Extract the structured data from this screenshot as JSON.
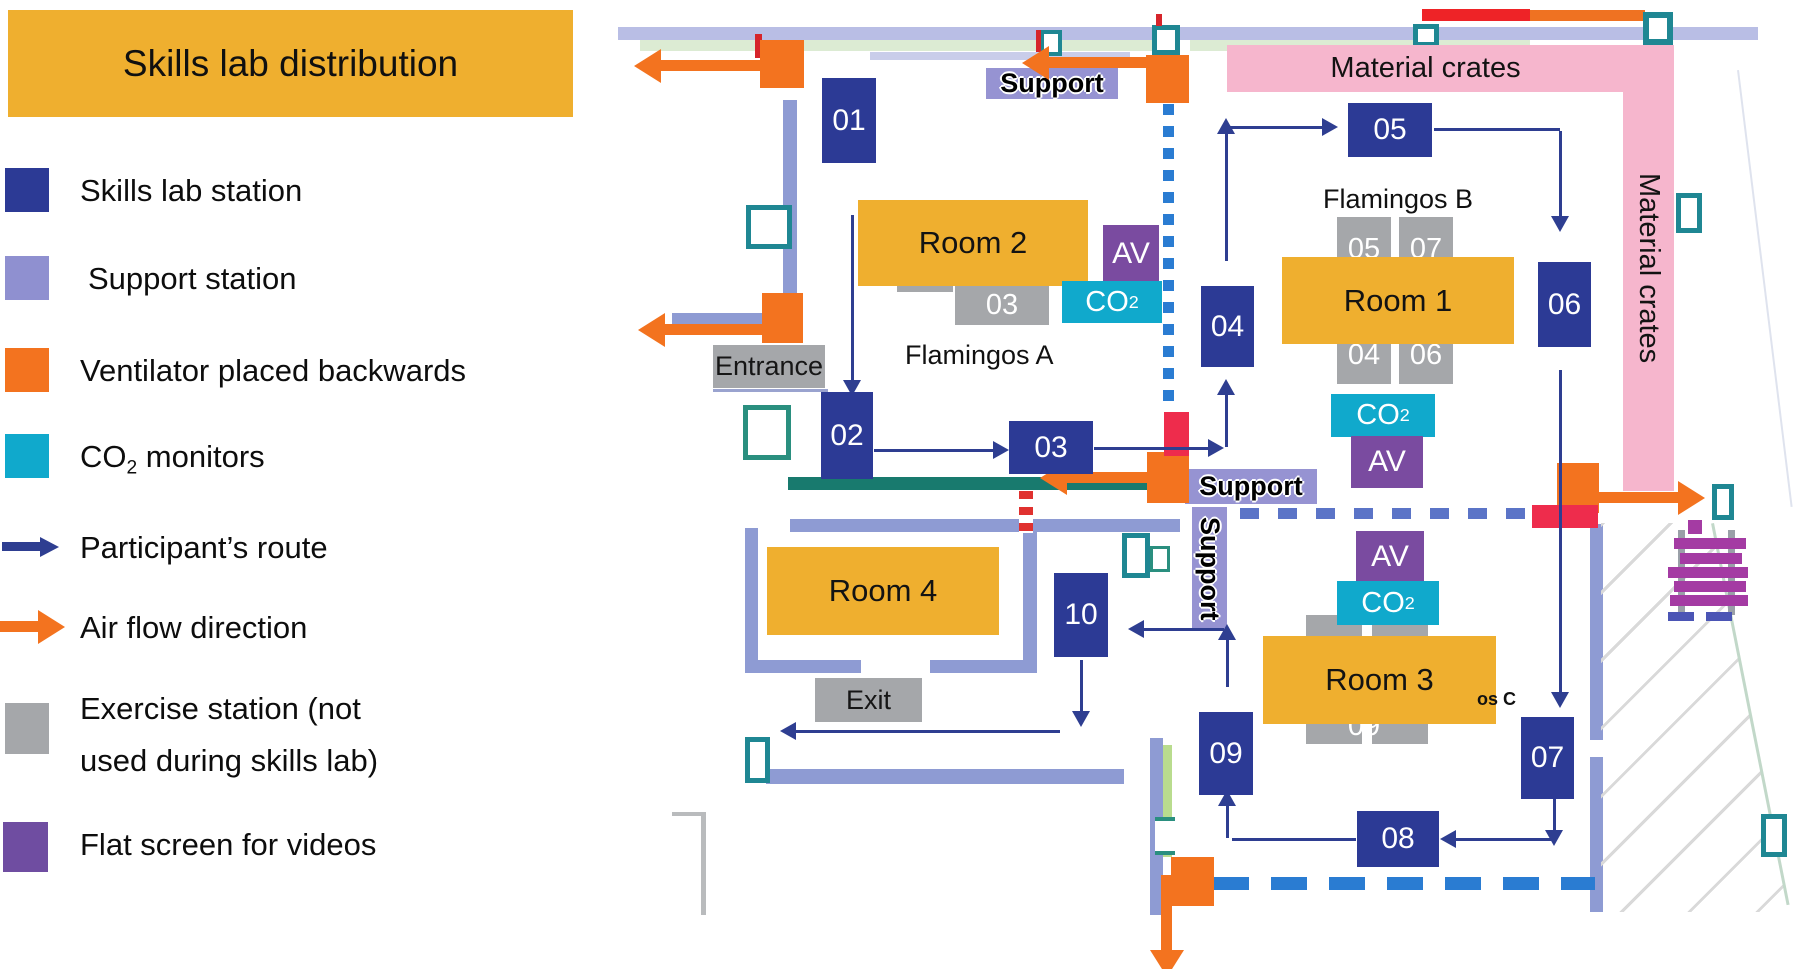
{
  "legend": {
    "title": "Skills lab distribution",
    "items": {
      "skills": "Skills lab station",
      "support": "Support station",
      "ventilator": "Ventilator placed backwards",
      "co2_prefix": "CO",
      "co2_sub": "2",
      "co2_suffix": " monitors",
      "route": "Participant’s route",
      "airflow": "Air flow direction",
      "exercise_line1": "Exercise station (not",
      "exercise_line2": "used during skills lab)",
      "flatscreen": "Flat screen for videos"
    }
  },
  "plan": {
    "stations": {
      "s01": "01",
      "s02": "02",
      "s03": "03",
      "s04": "04",
      "s05": "05",
      "s06": "06",
      "s07": "07",
      "s08": "08",
      "s09": "09",
      "s10": "10"
    },
    "gray": {
      "g03": "03",
      "g05": "05",
      "g04": "04",
      "g07": "07",
      "g06": "06",
      "g09": "09"
    },
    "rooms": {
      "room1": "Room 1",
      "room2": "Room 2",
      "room3": "Room 3",
      "room4": "Room 4"
    },
    "zones": {
      "flamingos_a": "Flamingos A",
      "flamingos_b": "Flamingos B",
      "flamingos_c_partial": "os C"
    },
    "labels": {
      "entrance": "Entrance",
      "exit": "Exit",
      "support": "Support",
      "material_crates": "Material crates",
      "av": "AV",
      "co2_main": "CO",
      "co2_sub": "2"
    }
  },
  "colors": {
    "station_blue": "#2c3a95",
    "support_purple": "#8f90d0",
    "ventilator_orange": "#f3731f",
    "co2_cyan": "#10a9cc",
    "route_navy": "#2e3e91",
    "exercise_gray": "#a5a7aa",
    "flatscreen_purple": "#6f4da1",
    "header_amber": "#efaf2f",
    "crates_pink": "#f6b6cd"
  }
}
